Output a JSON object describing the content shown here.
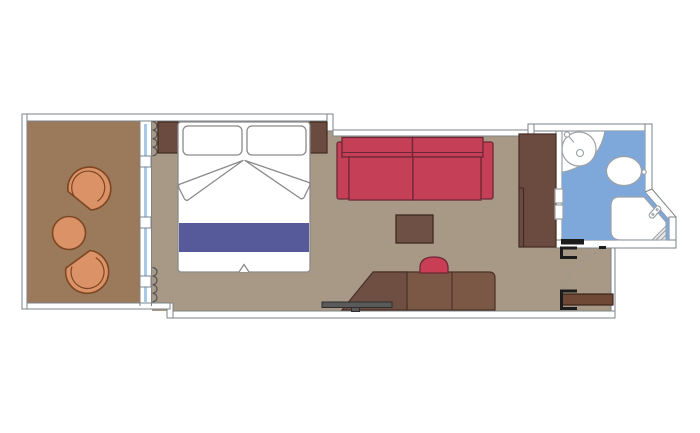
{
  "plan": {
    "type": "cabin-floor-plan",
    "canvas": {
      "width": 700,
      "height": 433
    },
    "rooms": [
      {
        "name": "balcony"
      },
      {
        "name": "bedroom-living-area"
      },
      {
        "name": "bathroom"
      },
      {
        "name": "entry-corridor"
      }
    ],
    "furniture": [
      "tub-chair-top",
      "round-table",
      "tub-chair-bottom",
      "sliding-glass-door",
      "curtain-top",
      "curtain-bottom",
      "nightstand-left",
      "double-bed",
      "pillow-left",
      "pillow-right",
      "sheet-fold-left",
      "sheet-fold-right",
      "bed-runner",
      "nightstand-right",
      "sofa",
      "coffee-table",
      "stool",
      "desk",
      "tv",
      "wardrobe",
      "washbasin",
      "toilet",
      "shower",
      "bathroom-door",
      "entry-door",
      "door-swing-arc"
    ]
  },
  "colors": {
    "wall_line": "#7e8387",
    "balcony_floor": "#9b7a5b",
    "room_floor": "#a89886",
    "chair_fill": "#db9267",
    "chair_line": "#7c4722",
    "dark_brown": "#6b4a40",
    "dark_brown_line": "#402b20",
    "bed_line": "#8a8a8a",
    "stripe_blue": "#575a9a",
    "sofa_red": "#c54056",
    "sofa_line": "#6f2737",
    "table_brown": "#6f5044",
    "table_line": "#3c2a1f",
    "stool_red": "#c93e54",
    "desk_brown": "#7b5746",
    "desk_dark": "#6f4f42",
    "desk_line": "#4a3226",
    "tv_gray": "#5a5a5a",
    "tv_line": "#2e2e2e",
    "door_brown": "#6f4936",
    "door_line": "#3a2417",
    "black": "#1c1c1c",
    "bath_blue": "#7fa8da",
    "fixture_line": "#9ba1a7",
    "curtain": "#555555",
    "dash_line": "#9a9892",
    "glass_blue": "#a9c9e6"
  }
}
